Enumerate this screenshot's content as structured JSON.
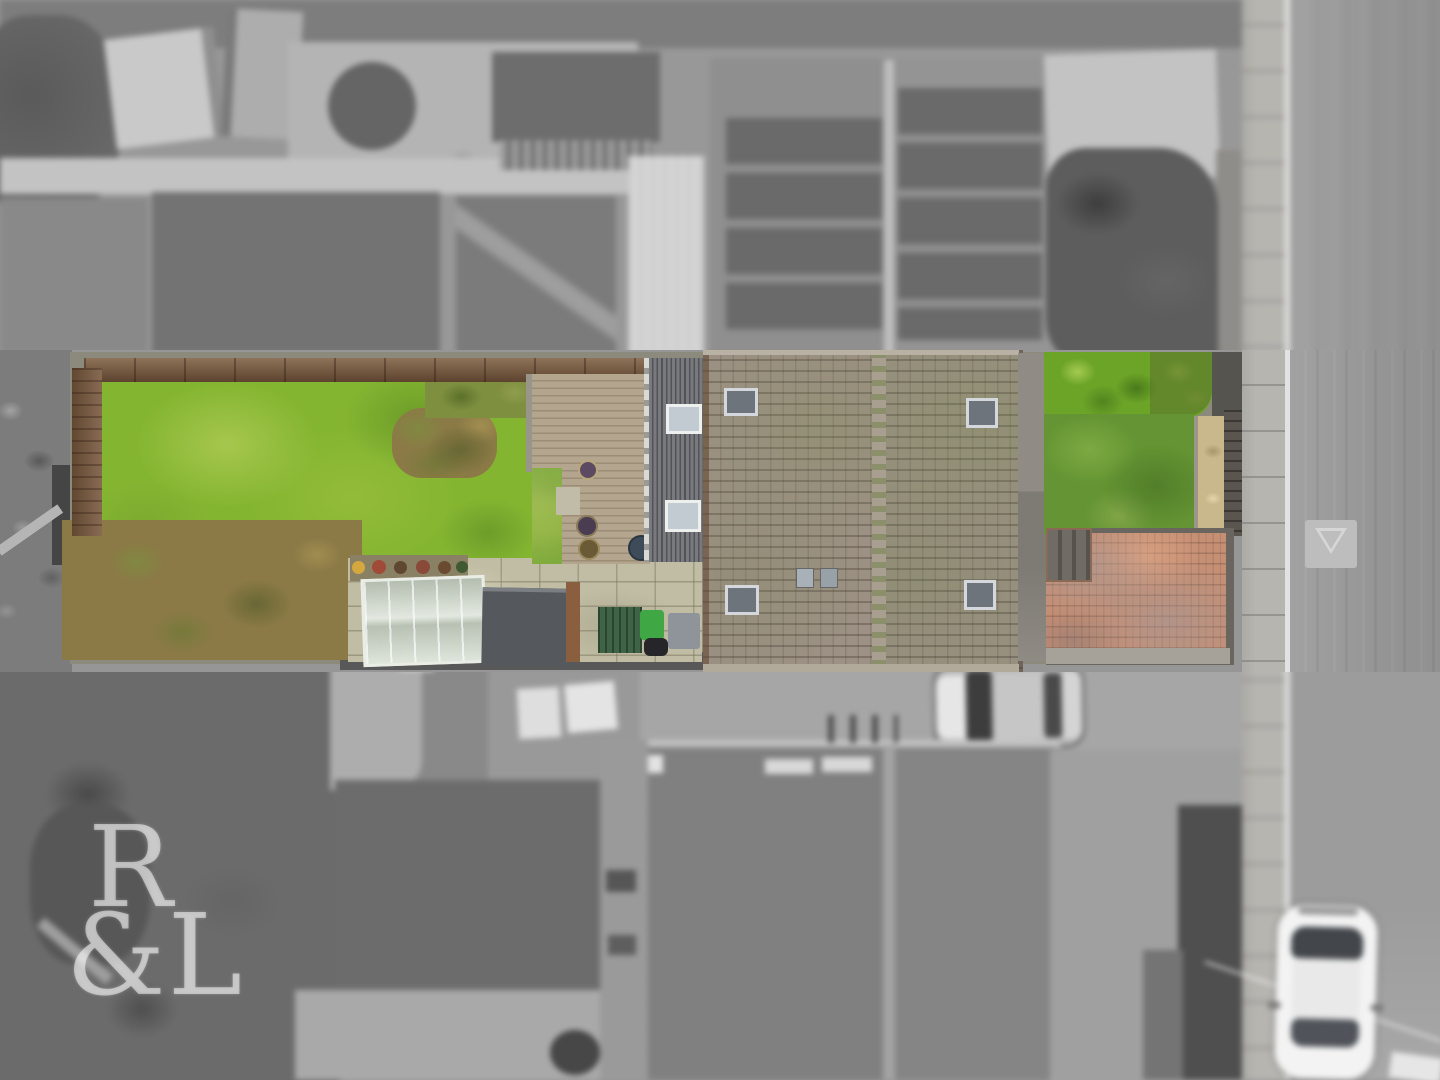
{
  "image": {
    "type": "aerial-drone-photo",
    "style": "top-down estate-agent photo; subject plot shown in colour, surroundings desaturated grey and blurred (tilt-shift)",
    "watermark": {
      "line1": "R",
      "line2": "&L"
    },
    "palette": {
      "lawn_green": "#84b531",
      "front_lawn_green": "#649433",
      "hedge_green": "#6ca428",
      "roof_tile_brown_grey": "#9c9184",
      "extension_slate_grey": "#797a7e",
      "deck_wood_tan": "#b4a58f",
      "patio_paving_beige": "#c1bda4",
      "driveway_brick_orange": "#c58f74",
      "fence_brown": "#7b5a3d",
      "greenhouse_glass": "#d3dccf",
      "bin_lid_green": "#3fa844",
      "road_grey": "#9c9c9c",
      "pavement_grey": "#b6b5b0",
      "curb_white": "#e2e2e2",
      "white_car_body": "#f3f3f3",
      "surroundings_grey": "#969696"
    },
    "regions": [
      {
        "name": "back-garden-lawn",
        "note": "large green lawn with brown fence on top and left, dry shrubs lower left"
      },
      {
        "name": "wood-deck",
        "note": "tan decking with plant pots beside rear extension"
      },
      {
        "name": "rear-extension-roof",
        "note": "dark grey striped roof with two white-framed skylights"
      },
      {
        "name": "patio",
        "note": "beige paving slabs with greenhouse, dark shed, green bin store, grey box"
      },
      {
        "name": "main-house-roof",
        "note": "brown-grey tiled hipped roof with central ridge, four dark skylights and two small vents"
      },
      {
        "name": "front-hedge",
        "note": "bright green trimmed hedge along top of front garden"
      },
      {
        "name": "front-lawn",
        "note": "mossy green front lawn with tan gravel bed and dark fence to the right"
      },
      {
        "name": "brick-driveway",
        "note": "orange block-paved driveway with dark edging and corner steps"
      },
      {
        "name": "pavement-and-road",
        "note": "grey footpath, white curb line, asphalt road running vertically on the right"
      },
      {
        "name": "give-way-triangle",
        "note": "painted triangle road marking"
      },
      {
        "name": "white-car",
        "note": "white car parked on road, bottom right, dark windscreen and rear window"
      },
      {
        "name": "grey-car",
        "note": "desaturated neighbour car parked between houses below the plot"
      },
      {
        "name": "neighbour-house-top",
        "note": "blurred grey gabled roof with solar panels above the plot"
      },
      {
        "name": "neighbour-house-bottom",
        "note": "blurred grey tiled gabled roof below the plot"
      },
      {
        "name": "neighbour-gardens",
        "note": "blurred grey allotment-style gardens, sheds and greenhouse surrounding"
      },
      {
        "name": "watermark",
        "note": "semi-transparent white serif R&L agency watermark, bottom left"
      }
    ]
  },
  "watermark": {
    "line1": "R",
    "line2": "&L"
  }
}
